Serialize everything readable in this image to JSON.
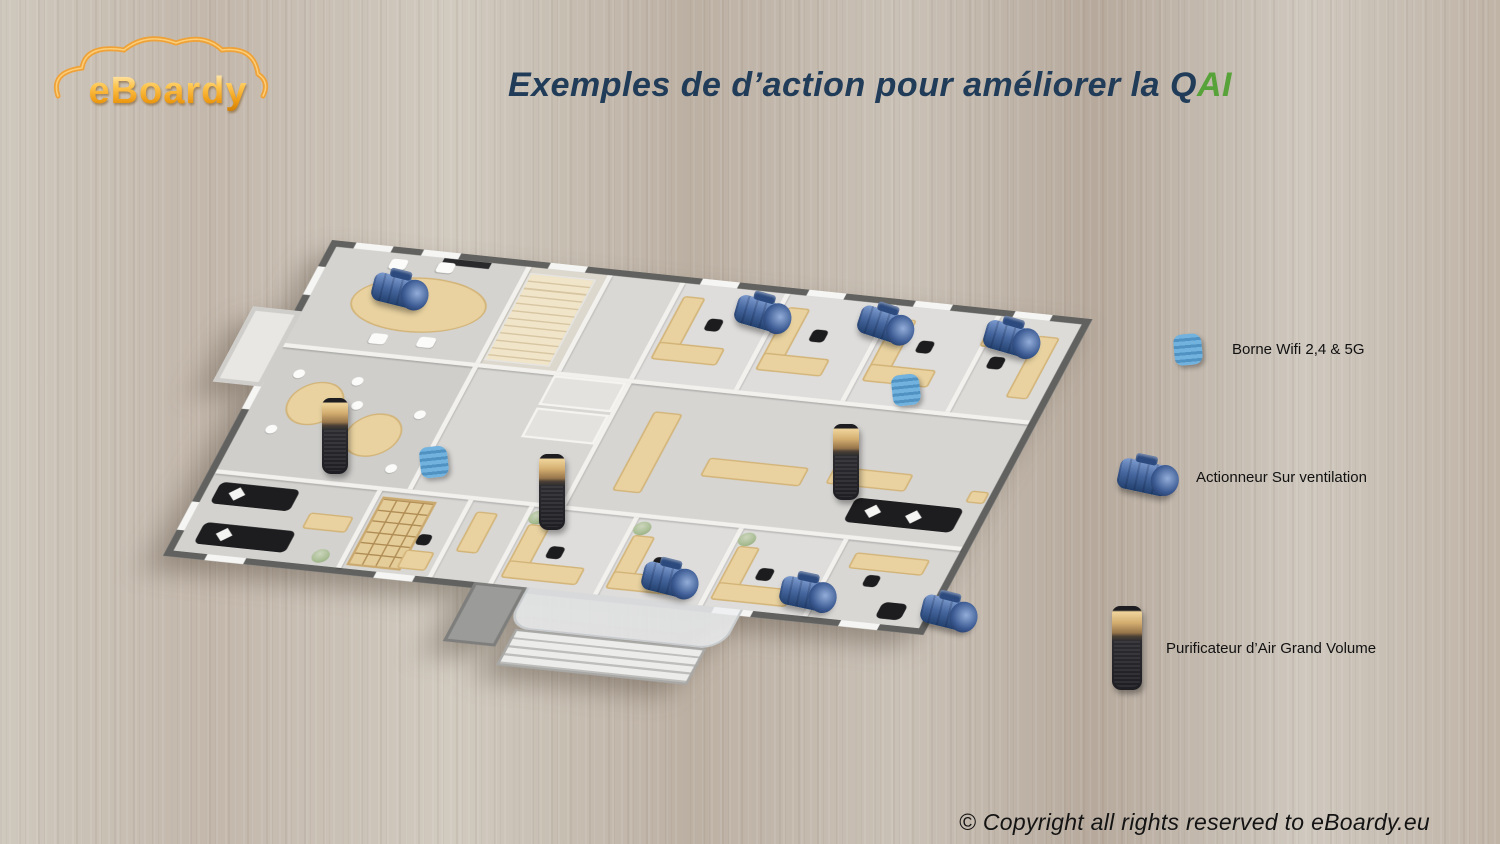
{
  "slide": {
    "logo": {
      "text": "eBoardy"
    },
    "title": {
      "main": "Exemples de d’action pour améliorer la Q",
      "accent": "AI"
    },
    "copyright": "© Copyright all rights reserved to eBoardy.eu"
  },
  "legend": {
    "items": [
      {
        "icon": "wifi-borne-icon",
        "label": "Borne Wifi 2,4 & 5G"
      },
      {
        "icon": "ventilation-actuator-icon",
        "label": "Actionneur Sur ventilation"
      },
      {
        "icon": "air-purifier-icon",
        "label": "Purificateur d’Air Grand Volume"
      }
    ]
  },
  "colors": {
    "title_text": "#203c58",
    "title_accent": "#58a339",
    "logo_orange": "#f0a032",
    "wifi_blue": "#5b9fd4",
    "actuator_blue": "#2f4f8c",
    "purifier_gold": "#c7a269",
    "wood_background": "#c8bfb5"
  },
  "devices": [
    {
      "type": "ventilation-actuator",
      "x": 26.5,
      "y": 34.5,
      "rot": 14
    },
    {
      "type": "ventilation-actuator",
      "x": 50.7,
      "y": 37.2,
      "rot": 16
    },
    {
      "type": "ventilation-actuator",
      "x": 58.9,
      "y": 38.5,
      "rot": 18
    },
    {
      "type": "ventilation-actuator",
      "x": 67.3,
      "y": 40.2,
      "rot": 16
    },
    {
      "type": "ventilation-actuator",
      "x": 44.5,
      "y": 68.7,
      "rot": 14
    },
    {
      "type": "ventilation-actuator",
      "x": 53.7,
      "y": 70.4,
      "rot": 12
    },
    {
      "type": "ventilation-actuator",
      "x": 63.1,
      "y": 72.6,
      "rot": 14
    },
    {
      "type": "wifi-borne",
      "x": 28.9,
      "y": 54.7,
      "rot": -6
    },
    {
      "type": "wifi-borne",
      "x": 60.4,
      "y": 46.2,
      "rot": -6
    },
    {
      "type": "air-purifier",
      "x": 22.3,
      "y": 51.7,
      "rot": 0
    },
    {
      "type": "air-purifier",
      "x": 36.8,
      "y": 58.3,
      "rot": 0
    },
    {
      "type": "air-purifier",
      "x": 56.4,
      "y": 54.7,
      "rot": 0
    }
  ]
}
